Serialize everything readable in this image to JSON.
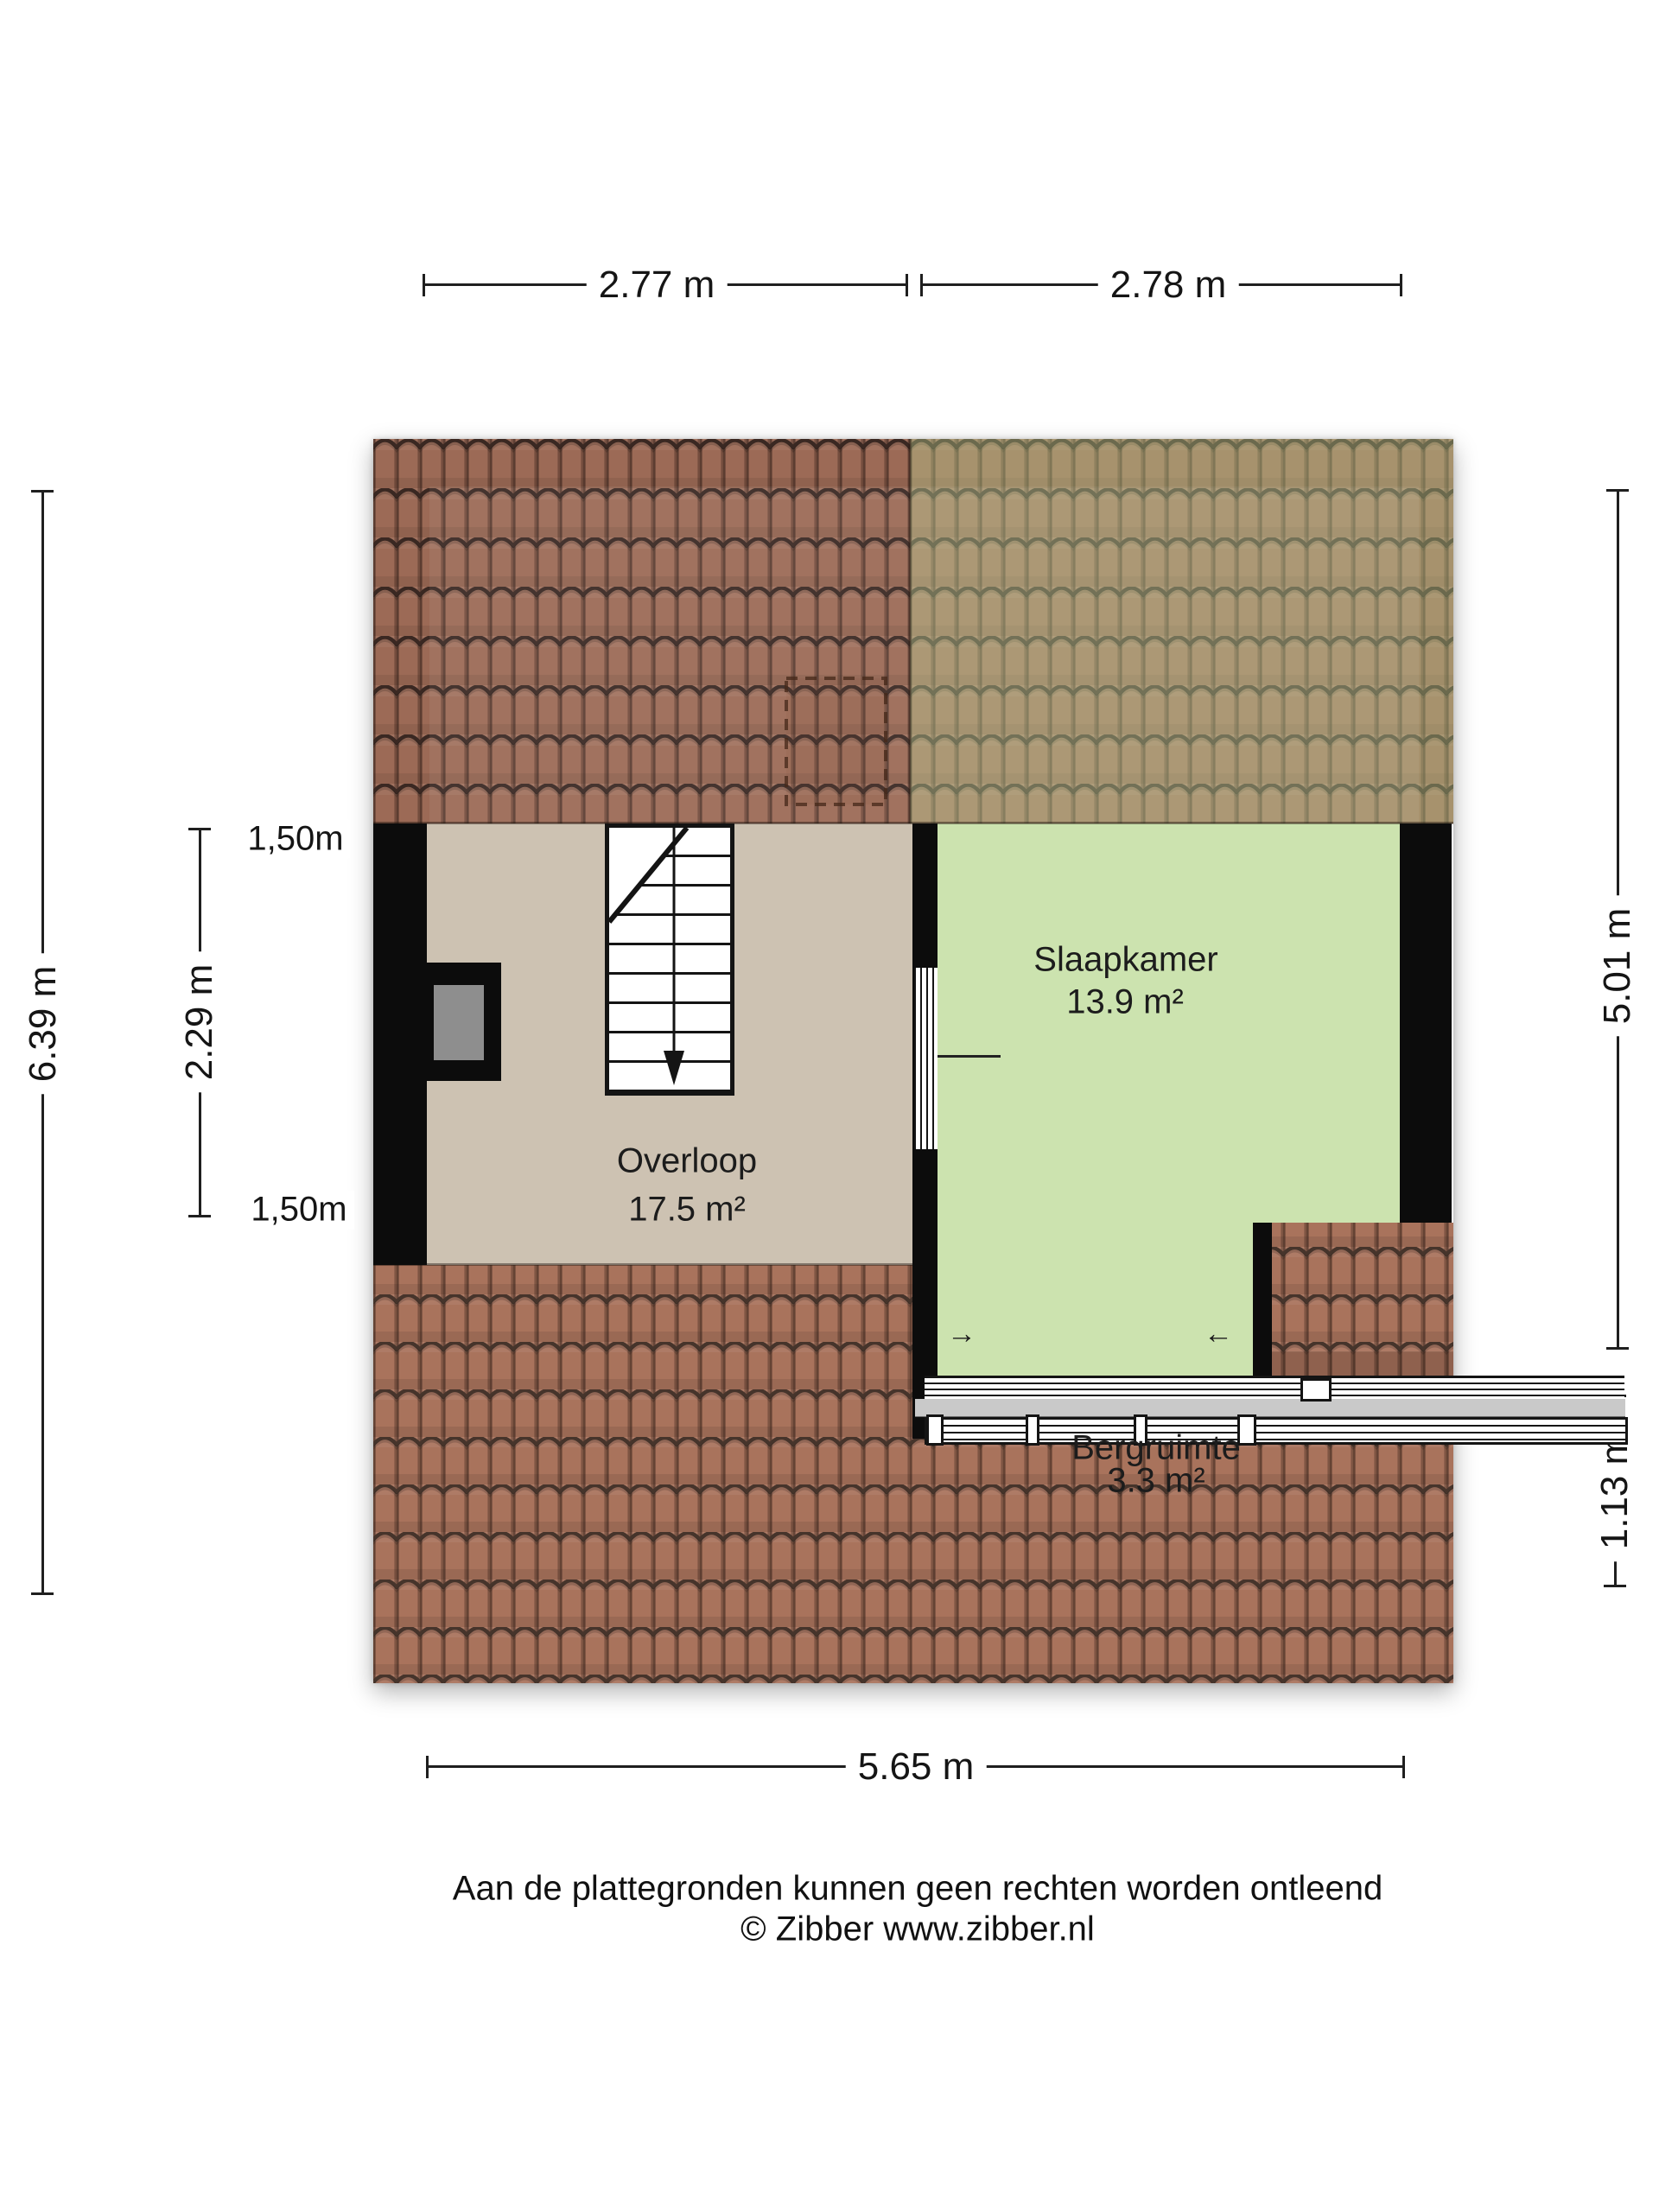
{
  "floorplan": {
    "rooms": [
      {
        "name": "Overloop",
        "area": "17.5 m²"
      },
      {
        "name": "Slaapkamer",
        "area": "13.9 m²"
      },
      {
        "name": "Bergruimte",
        "area": "3.3 m²"
      }
    ],
    "dimensions": {
      "top_left": {
        "label": "2.77 m"
      },
      "top_right": {
        "label": "2.78 m"
      },
      "left_outer": {
        "label": "6.39 m"
      },
      "left_inner": {
        "label": "2.29 m"
      },
      "left_seg_top": {
        "label": "1,50m"
      },
      "left_seg_bottom": {
        "label": "1,50m"
      },
      "right_outer": {
        "label": "5.01 m"
      },
      "right_lower": {
        "label": "1.13 m"
      },
      "bottom": {
        "label": "5.65 m"
      }
    },
    "icons": {
      "window_arrow_right": "→",
      "window_arrow_left": "←"
    },
    "colors": {
      "roof_top": "#9c6a56",
      "roof_lower": "#a9735c",
      "roof_line": "#3a2822",
      "bedroom_roof_tint": "rgba(186,214,146,0.38)",
      "overloop_floor": "#cdc2b2",
      "slaapkamer_floor": "#cce3af",
      "wall": "#0c0c0c",
      "sill_gray": "#c9c9c9",
      "chimney_gray": "#8e8e8e"
    }
  },
  "footer": {
    "disclaimer": "Aan de plattegronden kunnen geen rechten worden ontleend",
    "credit": "© Zibber www.zibber.nl"
  }
}
